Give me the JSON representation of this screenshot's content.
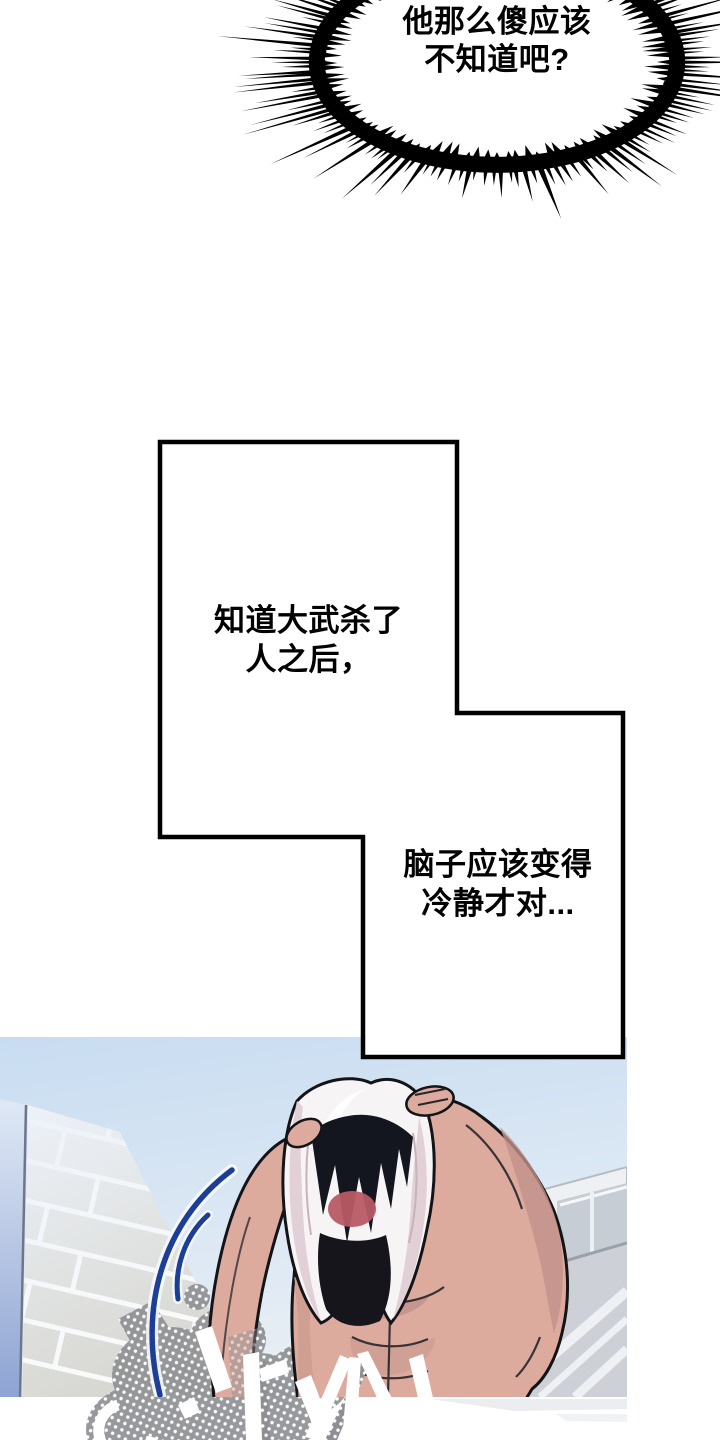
{
  "burst_bubble": {
    "lines": [
      "他那么傻应该",
      "不知道吧?"
    ]
  },
  "thought_panel": {
    "first_text": {
      "lines": [
        "知道大武杀了",
        "人之后，"
      ]
    },
    "second_text": {
      "lines": [
        "脑子应该变得",
        "冷静才对..."
      ]
    }
  },
  "colors": {
    "background": "#ffffff",
    "panel_border": "#000000",
    "text": "#000000",
    "sky": "#cfe2f4",
    "tile": "#d7d7d1",
    "wall_accent": "#8da3d2",
    "skin": "#dcab9e",
    "skin_shadow": "#c2918a",
    "hair": "#14161f",
    "towel": "#f7f4f5",
    "towel_shadow": "#e2d0d7",
    "blush": "#b85a64",
    "motion_line": "#1c3e96",
    "halftone_gray": "#8d8f92",
    "outline": "#141418"
  }
}
